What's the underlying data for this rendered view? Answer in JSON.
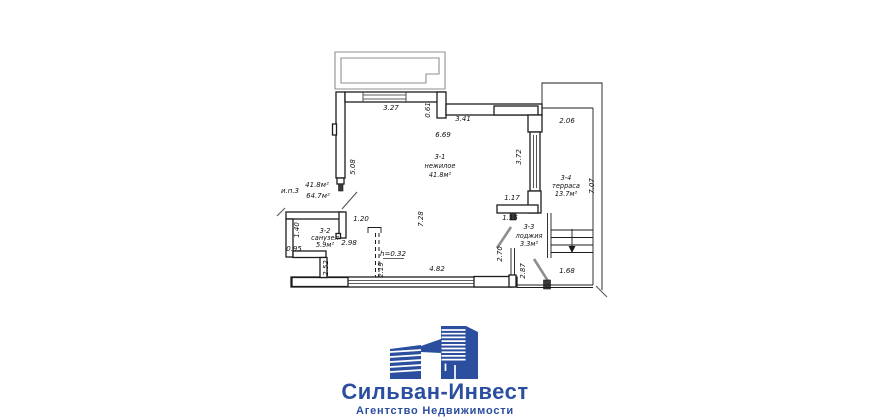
{
  "plan": {
    "unit_label": {
      "name": "и.п.3",
      "area_total_1": "41.8м²",
      "area_total_2": "64.7м²"
    },
    "rooms": {
      "r31": {
        "id": "3-1",
        "type": "нежилое",
        "area": "41.8м²"
      },
      "r32": {
        "id": "3-2",
        "type": "санузел",
        "area": "5.9м²"
      },
      "r33": {
        "id": "3-3",
        "type": "лоджия",
        "area": "3.3м²"
      },
      "r34": {
        "id": "3-4",
        "type": "терраса",
        "area": "13.7м²"
      }
    },
    "dims": {
      "d327": "3.27",
      "d061": "0.61",
      "d341": "3.41",
      "d206": "2.06",
      "d669": "6.69",
      "d508": "5.08",
      "d372": "3.72",
      "d707": "7.07",
      "d117": "1.17",
      "d728": "7.28",
      "d120": "1.20",
      "d115": "1.15",
      "d140": "1.40",
      "d298": "2.98",
      "d095": "0.95",
      "d252": "2.52",
      "dh032": "h=0.32",
      "d219": "2.19",
      "d482": "4.82",
      "d270": "2.70",
      "d287": "2.87",
      "d168": "1.68"
    }
  },
  "logo": {
    "title": "Сильван-Инвест",
    "subtitle": "Агентство Недвижимости",
    "brand_color": "#2b4e9f"
  }
}
